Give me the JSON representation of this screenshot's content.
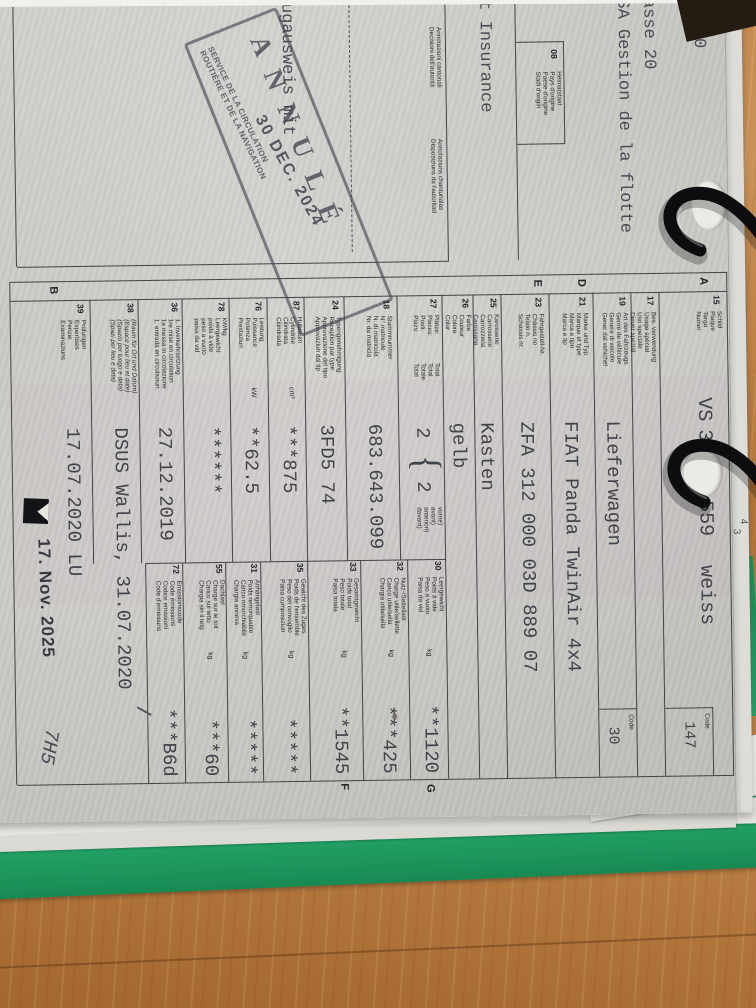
{
  "photo": {
    "desk_color": "#b5773f",
    "folder_color": "#23a165",
    "paper_color": "#d0cec9",
    "ring_color": "#0d0d0f"
  },
  "edge_digits": {
    "d1": "2",
    "d2": "4",
    "d3": "3"
  },
  "header": {
    "line1": "72.00",
    "line2": "asse 20",
    "line3": "SA Gestion de la flotte",
    "insurance": "t Insurance",
    "heimatstaat": {
      "num": "08",
      "labels": [
        "Heimatstaat",
        "Pays d'origine",
        "Paese d'origine",
        "Stadi d'origin"
      ]
    }
  },
  "annotations": {
    "label_it_1": "Annotazioni cantonali",
    "label_it_2": "Decisioni dell'autorità",
    "label_rm_1": "Annotaziuns chantunalas",
    "label_rm_2": "Disposiziuns da l'autoritad",
    "fragment": "ugausweis mit"
  },
  "cancel_stamp": {
    "word": "ANNULÉ",
    "date": "30 DEC. 2024",
    "service_1": "SERVICE DE LA CIRCULATION",
    "service_2": "ROUTIÈRE ET DE LA NAVIGATION"
  },
  "plate": {
    "prefix": "VS",
    "num_a": "35",
    "num_b": "559",
    "color_word": "weiss"
  },
  "section_letters": {
    "a": "A",
    "d": "D",
    "e": "E",
    "b": "B",
    "g": "G",
    "f": "F"
  },
  "code_cells": {
    "row15": {
      "label": "Code",
      "value": "147"
    },
    "row19": {
      "label": "Code",
      "value": "30"
    }
  },
  "row27": {
    "total_labels": [
      "Total",
      "Total",
      "Totale",
      "Total"
    ],
    "value_total": "2",
    "value_front": "2",
    "front_labels": [
      "vorne)",
      "avant)",
      "anteriori)",
      "davant)"
    ]
  },
  "table": {
    "left_rows": [
      {
        "num": "15",
        "labels": [
          "Schild",
          "Plaque",
          "Targa",
          "Numer"
        ],
        "value": ""
      },
      {
        "num": "17",
        "labels": [
          "Bes. Verwendung",
          "Usage spécial",
          "Uso speciale",
          "Diever spezial"
        ],
        "value": ""
      },
      {
        "num": "19",
        "labels": [
          "Art des Fahrzeugs",
          "Genre de véhicule",
          "Genere di veicolo",
          "Gener dal vehichel"
        ],
        "value": "Lieferwagen"
      },
      {
        "num": "21",
        "labels": [
          "Marke und Typ",
          "Marque et type",
          "Marca e tipo",
          "Marca e tip"
        ],
        "value": "FIAT Panda TwinAir 4x4"
      },
      {
        "num": "23",
        "labels": [
          "Fahrgestell-Nr.",
          "Châssis no",
          "Telaio n.",
          "Schassis nr."
        ],
        "value": "ZFA 312 000 03D 889 07"
      },
      {
        "num": "25",
        "labels": [
          "Karosserie",
          "Carrosserie",
          "Carrozzeria",
          "Carossaria"
        ],
        "value": "Kasten"
      },
      {
        "num": "26",
        "labels": [
          "Farbe",
          "Couleur",
          "Colore",
          "Colur"
        ],
        "value": "gelb"
      },
      {
        "num": "27",
        "labels": [
          "Plätze:",
          "Places:",
          "Posti:",
          "Plazs:"
        ],
        "value": ""
      },
      {
        "num": "18",
        "labels": [
          "Stammnummer",
          "N° matricule",
          "N. di matricola",
          "Nr. da matricla"
        ],
        "value": "683.643.099"
      },
      {
        "num": "24",
        "labels": [
          "Typengenehmigung",
          "Réception par type",
          "Approvazione del tipo",
          "Approvaziun dal tip"
        ],
        "value": "3FD5 74"
      },
      {
        "num": "87",
        "labels": [
          "Hubraum",
          "Cylindrée",
          "Cilindrata",
          "Cilindrada"
        ],
        "unit": "cm³",
        "value": "***875"
      },
      {
        "num": "76",
        "labels": [
          "Leistung",
          "Puissance",
          "Potenza",
          "Prestaziun"
        ],
        "unit": "kW",
        "value": "**62.5"
      },
      {
        "num": "78",
        "labels": [
          "kW/kg",
          "Leergewicht",
          "poids à vide",
          "peso a vuoto",
          "paisa da vid"
        ],
        "value": "******"
      },
      {
        "num": "36",
        "labels": [
          "1. Inverkehrsetzung",
          "1re mise en circulation",
          "1a messa in circolazione",
          "1. entrada en circulaziun"
        ],
        "value": "27.12.2019"
      },
      {
        "num": "38",
        "labels": [
          "(Raum für Ort und Datum)",
          "(Espace pour lieu et date)",
          "(Spazio per luogo e data)",
          "(Spazi per lieu e data)"
        ],
        "italic": true,
        "value": "DSUS Wallis, 31.07.2020"
      },
      {
        "num": "39",
        "labels": [
          "Prüfungen",
          "Expertises",
          "Perizie",
          "Examinaziuns"
        ],
        "value": "17.07.2020 LU"
      }
    ],
    "right_rows": [
      {
        "num": "30",
        "labels": [
          "Leergewicht",
          "Poids à vide",
          "Peso a vuoto",
          "Paisa da vid"
        ],
        "unit": "kg",
        "value": "**1120"
      },
      {
        "num": "32",
        "labels": [
          "Nutz-/Sattellast",
          "Charge utile/sellette",
          "Carico utile/sella",
          "Chargia utila/sella"
        ],
        "unit": "kg",
        "value": "***425"
      },
      {
        "num": "33",
        "labels": [
          "Gesamtgewicht",
          "Poids total",
          "Peso totale",
          "Paisa totala"
        ],
        "unit": "kg",
        "value": "**1545"
      },
      {
        "num": "35",
        "labels": [
          "Gewicht des Zuges",
          "Poids de l'ensemble",
          "Peso del convoglio",
          "Paisa cumposiziun"
        ],
        "unit": "kg",
        "value": "*****"
      },
      {
        "num": "31",
        "labels": [
          "Anhängelast",
          "Poids remorquable",
          "Carico rimorchiabile",
          "Chargia annexa"
        ],
        "unit": "kg",
        "value": "*****"
      },
      {
        "num": "55",
        "labels": [
          "Dachlast",
          "Charge sur le toit",
          "Carico sul tetto",
          "Chargia sin il tetg"
        ],
        "unit": "kg",
        "value": "***60"
      },
      {
        "num": "72",
        "labels": [
          "Emissionscode",
          "Code émissions",
          "Codice emissioni",
          "Code d'emissiuns"
        ],
        "value": "***B6d"
      }
    ]
  },
  "footer": {
    "date_stamp": "17. Nov. 2025",
    "handwriting": "7H5"
  }
}
